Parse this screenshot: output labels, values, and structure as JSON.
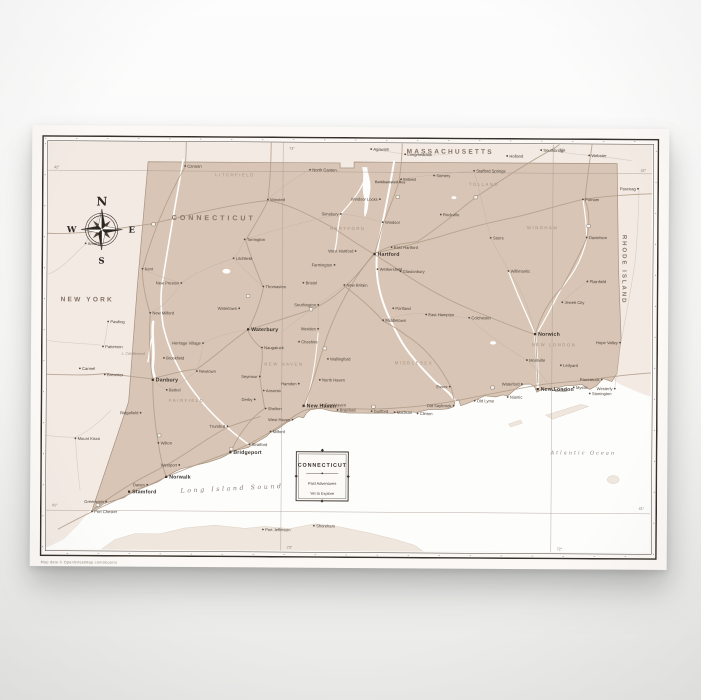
{
  "colors": {
    "state_fill": "#d8c5b5",
    "neighbor_land": "#f2eae3",
    "water": "#fdfdfc",
    "frame": "#38302a",
    "paper": "#fbf8f5"
  },
  "compass": {
    "north": "N",
    "east": "E",
    "south": "S",
    "west": "W"
  },
  "legend": {
    "title": "CONNECTICUT",
    "line1": "Past Adventures",
    "line2": "Yet to Explore"
  },
  "small_print": "Map data © OpenStreetMap contributors",
  "map": {
    "labels": [
      {
        "text": "MASSACHUSETTS",
        "x": 408,
        "y": 16,
        "cls": "t-state"
      },
      {
        "text": "NEW YORK",
        "x": 46,
        "y": 166,
        "cls": "t-state"
      },
      {
        "text": "RHODE ISLAND",
        "x": 581,
        "y": 131,
        "cls": "t-state-v",
        "rot": 90
      },
      {
        "text": "CONNECTICUT",
        "x": 172,
        "y": 84,
        "cls": "t-region"
      },
      {
        "text": "LITCHFIELD",
        "x": 193,
        "y": 40,
        "cls": "t-county"
      },
      {
        "text": "HARTFORD",
        "x": 306,
        "y": 93,
        "cls": "t-county"
      },
      {
        "text": "TOLLAND",
        "x": 442,
        "y": 48,
        "cls": "t-county"
      },
      {
        "text": "WINDHAM",
        "x": 501,
        "y": 91,
        "cls": "t-county"
      },
      {
        "text": "MIDDLESEX",
        "x": 373,
        "y": 227,
        "cls": "t-county"
      },
      {
        "text": "NEW HAVEN",
        "x": 243,
        "y": 229,
        "cls": "t-county"
      },
      {
        "text": "NEW LONDON",
        "x": 513,
        "y": 208,
        "cls": "t-county"
      },
      {
        "text": "FAIRFIELD",
        "x": 146,
        "y": 266,
        "cls": "t-county"
      },
      {
        "text": "Long Island Sound",
        "x": 192,
        "y": 354,
        "cls": "t-water",
        "rot": -3
      },
      {
        "text": "Atlantic Ocean",
        "x": 543,
        "y": 316,
        "cls": "t-water-sm"
      },
      {
        "text": "Barkhamsted Res",
        "x": 333,
        "y": 46,
        "cls": "t-poi"
      },
      {
        "text": "L. Candlewood",
        "x": 104,
        "y": 219,
        "cls": "t-lake",
        "a": "e"
      }
    ],
    "grid_labels": [
      {
        "text": "73°",
        "x": 247,
        "y": 13
      },
      {
        "text": "72°",
        "x": 517,
        "y": 13
      },
      {
        "text": "73°",
        "x": 247,
        "y": 412
      },
      {
        "text": "72°",
        "x": 517,
        "y": 412
      },
      {
        "text": "42°",
        "x": 604,
        "y": 33,
        "a": "e"
      },
      {
        "text": "41°",
        "x": 604,
        "y": 371,
        "a": "e"
      },
      {
        "text": "42°",
        "x": 12,
        "y": 33
      },
      {
        "text": "41°",
        "x": 12,
        "y": 371
      }
    ],
    "cities": [
      {
        "name": "Hartford",
        "x": 333,
        "y": 117,
        "t": "city"
      },
      {
        "name": "West Hartford",
        "x": 314,
        "y": 114,
        "t": "town",
        "a": "e"
      },
      {
        "name": "East Hartford",
        "x": 350,
        "y": 110,
        "t": "town"
      },
      {
        "name": "New Britain",
        "x": 303,
        "y": 148,
        "t": "town"
      },
      {
        "name": "Bristol",
        "x": 262,
        "y": 146,
        "t": "town"
      },
      {
        "name": "Southington",
        "x": 277,
        "y": 168,
        "t": "town",
        "a": "e"
      },
      {
        "name": "Meriden",
        "x": 277,
        "y": 192,
        "t": "town",
        "a": "e"
      },
      {
        "name": "Middletown",
        "x": 342,
        "y": 183,
        "t": "town"
      },
      {
        "name": "Waterbury",
        "x": 207,
        "y": 193,
        "t": "city"
      },
      {
        "name": "Naugatuck",
        "x": 221,
        "y": 211,
        "t": "town"
      },
      {
        "name": "Cheshire",
        "x": 258,
        "y": 205,
        "t": "town"
      },
      {
        "name": "Wallingford",
        "x": 287,
        "y": 222,
        "t": "town"
      },
      {
        "name": "North Haven",
        "x": 279,
        "y": 243,
        "t": "town"
      },
      {
        "name": "Hamden",
        "x": 258,
        "y": 247,
        "t": "town",
        "a": "e"
      },
      {
        "name": "New Haven",
        "x": 263,
        "y": 269,
        "t": "city"
      },
      {
        "name": "West Haven",
        "x": 252,
        "y": 283,
        "t": "town",
        "a": "e"
      },
      {
        "name": "East Haven",
        "x": 282,
        "y": 268,
        "t": "town"
      },
      {
        "name": "Branford",
        "x": 297,
        "y": 273,
        "t": "town"
      },
      {
        "name": "Guilford",
        "x": 331,
        "y": 274,
        "t": "town"
      },
      {
        "name": "Madison",
        "x": 354,
        "y": 275,
        "t": "town"
      },
      {
        "name": "Clinton",
        "x": 377,
        "y": 276,
        "t": "town"
      },
      {
        "name": "Old Saybrook",
        "x": 413,
        "y": 268,
        "t": "town",
        "a": "e"
      },
      {
        "name": "Old Lyme",
        "x": 434,
        "y": 263,
        "t": "town"
      },
      {
        "name": "Essex",
        "x": 409,
        "y": 249,
        "t": "town",
        "a": "e"
      },
      {
        "name": "Niantic",
        "x": 467,
        "y": 259,
        "t": "town"
      },
      {
        "name": "Waterford",
        "x": 481,
        "y": 246,
        "t": "town",
        "a": "e"
      },
      {
        "name": "New London",
        "x": 497,
        "y": 251,
        "t": "city"
      },
      {
        "name": "Groton",
        "x": 512,
        "y": 252,
        "t": "town"
      },
      {
        "name": "Mystic",
        "x": 533,
        "y": 249,
        "t": "town"
      },
      {
        "name": "Stonington",
        "x": 549,
        "y": 255,
        "t": "town"
      },
      {
        "name": "Pawcatuck",
        "x": 561,
        "y": 241,
        "t": "town",
        "a": "e"
      },
      {
        "name": "Norwich",
        "x": 494,
        "y": 196,
        "t": "city"
      },
      {
        "name": "Montville",
        "x": 486,
        "y": 222,
        "t": "town"
      },
      {
        "name": "Ledyard",
        "x": 520,
        "y": 227,
        "t": "town"
      },
      {
        "name": "Jewett City",
        "x": 521,
        "y": 164,
        "t": "town"
      },
      {
        "name": "Plainfield",
        "x": 546,
        "y": 143,
        "t": "town"
      },
      {
        "name": "Danielson",
        "x": 545,
        "y": 99,
        "t": "town"
      },
      {
        "name": "Putnam",
        "x": 541,
        "y": 61,
        "t": "town"
      },
      {
        "name": "Willimantic",
        "x": 467,
        "y": 133,
        "t": "town"
      },
      {
        "name": "Storrs",
        "x": 449,
        "y": 100,
        "t": "town"
      },
      {
        "name": "Stafford Springs",
        "x": 432,
        "y": 33,
        "t": "town"
      },
      {
        "name": "Rockville",
        "x": 399,
        "y": 77,
        "t": "town"
      },
      {
        "name": "Somers",
        "x": 392,
        "y": 38,
        "t": "town"
      },
      {
        "name": "Enfield",
        "x": 359,
        "y": 42,
        "t": "town"
      },
      {
        "name": "Windsor Locks",
        "x": 338,
        "y": 62,
        "t": "town",
        "a": "e"
      },
      {
        "name": "Windsor",
        "x": 341,
        "y": 85,
        "t": "town"
      },
      {
        "name": "Simsbury",
        "x": 299,
        "y": 77,
        "t": "town",
        "a": "e"
      },
      {
        "name": "North Canton",
        "x": 268,
        "y": 33,
        "t": "town"
      },
      {
        "name": "Colchester",
        "x": 428,
        "y": 180,
        "t": "town"
      },
      {
        "name": "East Hampton",
        "x": 385,
        "y": 177,
        "t": "town"
      },
      {
        "name": "Portland",
        "x": 352,
        "y": 171,
        "t": "town"
      },
      {
        "name": "Glastonbury",
        "x": 359,
        "y": 134,
        "t": "town"
      },
      {
        "name": "Wethersfield",
        "x": 336,
        "y": 132,
        "t": "town"
      },
      {
        "name": "Farmington",
        "x": 293,
        "y": 128,
        "t": "town",
        "a": "e"
      },
      {
        "name": "Torrington",
        "x": 203,
        "y": 103,
        "t": "town"
      },
      {
        "name": "Winsted",
        "x": 226,
        "y": 63,
        "t": "town"
      },
      {
        "name": "Canaan",
        "x": 143,
        "y": 30,
        "t": "town"
      },
      {
        "name": "Litchfield",
        "x": 192,
        "y": 122,
        "t": "town"
      },
      {
        "name": "Thomaston",
        "x": 222,
        "y": 150,
        "t": "town"
      },
      {
        "name": "Watertown",
        "x": 198,
        "y": 172,
        "t": "town",
        "a": "e"
      },
      {
        "name": "Heritage Village",
        "x": 162,
        "y": 207,
        "t": "town",
        "a": "e"
      },
      {
        "name": "New Preston",
        "x": 140,
        "y": 147,
        "t": "town",
        "a": "e"
      },
      {
        "name": "Kent",
        "x": 101,
        "y": 133,
        "t": "town"
      },
      {
        "name": "New Milford",
        "x": 109,
        "y": 177,
        "t": "town"
      },
      {
        "name": "Brookfield",
        "x": 123,
        "y": 222,
        "t": "town"
      },
      {
        "name": "Danbury",
        "x": 112,
        "y": 244,
        "t": "city"
      },
      {
        "name": "Bethel",
        "x": 126,
        "y": 254,
        "t": "town"
      },
      {
        "name": "Newtown",
        "x": 156,
        "y": 235,
        "t": "town"
      },
      {
        "name": "Ridgefield",
        "x": 100,
        "y": 277,
        "t": "town",
        "a": "e"
      },
      {
        "name": "Wilton",
        "x": 118,
        "y": 307,
        "t": "town"
      },
      {
        "name": "Westport",
        "x": 139,
        "y": 329,
        "t": "town",
        "a": "e"
      },
      {
        "name": "Norwalk",
        "x": 126,
        "y": 341,
        "t": "city"
      },
      {
        "name": "Darien",
        "x": 107,
        "y": 349,
        "t": "town",
        "a": "e"
      },
      {
        "name": "Stamford",
        "x": 89,
        "y": 356,
        "t": "city"
      },
      {
        "name": "Greenwich",
        "x": 66,
        "y": 366,
        "t": "town",
        "a": "e"
      },
      {
        "name": "Port Chester",
        "x": 52,
        "y": 376,
        "t": "town"
      },
      {
        "name": "Seymour",
        "x": 219,
        "y": 240,
        "t": "town",
        "a": "e"
      },
      {
        "name": "Ansonia",
        "x": 223,
        "y": 254,
        "t": "town"
      },
      {
        "name": "Derby",
        "x": 214,
        "y": 263,
        "t": "town",
        "a": "e"
      },
      {
        "name": "Shelton",
        "x": 225,
        "y": 272,
        "t": "town"
      },
      {
        "name": "Trumbull",
        "x": 187,
        "y": 290,
        "t": "town",
        "a": "e"
      },
      {
        "name": "Bridgeport",
        "x": 190,
        "y": 316,
        "t": "city"
      },
      {
        "name": "Stratford",
        "x": 209,
        "y": 308,
        "t": "town"
      },
      {
        "name": "Milford",
        "x": 230,
        "y": 295,
        "t": "town"
      },
      {
        "name": "Amenia",
        "x": 44,
        "y": 108,
        "t": "town"
      },
      {
        "name": "Pawling",
        "x": 67,
        "y": 186,
        "t": "town"
      },
      {
        "name": "Patterson",
        "x": 62,
        "y": 211,
        "t": "town"
      },
      {
        "name": "Carmel",
        "x": 39,
        "y": 233,
        "t": "town"
      },
      {
        "name": "Brewster",
        "x": 64,
        "y": 239,
        "t": "town"
      },
      {
        "name": "Mount Kisco",
        "x": 35,
        "y": 303,
        "t": "town"
      },
      {
        "name": "Agawam",
        "x": 329,
        "y": 12,
        "t": "town"
      },
      {
        "name": "Longmeadow",
        "x": 363,
        "y": 17,
        "t": "town"
      },
      {
        "name": "Holland",
        "x": 465,
        "y": 18,
        "t": "town"
      },
      {
        "name": "Southbridge",
        "x": 499,
        "y": 12,
        "t": "town"
      },
      {
        "name": "Webster",
        "x": 547,
        "y": 17,
        "t": "town"
      },
      {
        "name": "Pascoag",
        "x": 596,
        "y": 50,
        "t": "town",
        "a": "e"
      },
      {
        "name": "Hope Valley",
        "x": 579,
        "y": 204,
        "t": "town",
        "a": "e"
      },
      {
        "name": "Westerly",
        "x": 574,
        "y": 250,
        "t": "town",
        "a": "e"
      },
      {
        "name": "Port Jefferson",
        "x": 223,
        "y": 393,
        "t": "town"
      },
      {
        "name": "Shoreham",
        "x": 274,
        "y": 389,
        "t": "town"
      }
    ]
  }
}
